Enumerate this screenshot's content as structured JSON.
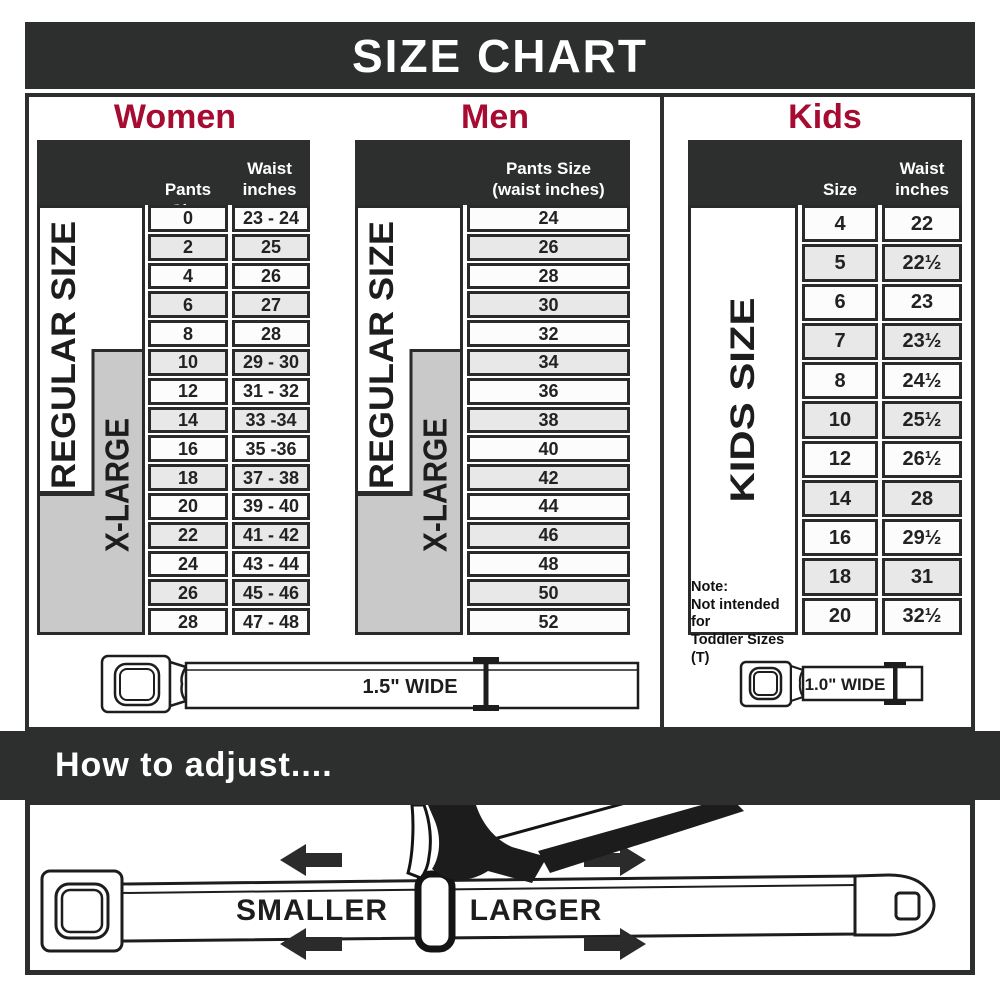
{
  "title": "SIZE CHART",
  "colors": {
    "dark": "#2d2e2e",
    "accent_crimson": "#a60c31",
    "xlarge_gray": "#c9c9c9",
    "row_alt": "#e8e8e8"
  },
  "women": {
    "heading": "Women",
    "col_pants": "Pants Size",
    "col_waist_line1": "Waist",
    "col_waist_line2": "inches",
    "regular_label": "REGULAR SIZE",
    "xlarge_label": "X-LARGE",
    "rows": [
      {
        "size": "0",
        "waist": "23 - 24"
      },
      {
        "size": "2",
        "waist": "25"
      },
      {
        "size": "4",
        "waist": "26"
      },
      {
        "size": "6",
        "waist": "27"
      },
      {
        "size": "8",
        "waist": "28"
      },
      {
        "size": "10",
        "waist": "29 - 30"
      },
      {
        "size": "12",
        "waist": "31 - 32"
      },
      {
        "size": "14",
        "waist": "33 -34"
      },
      {
        "size": "16",
        "waist": "35 -36"
      },
      {
        "size": "18",
        "waist": "37 - 38"
      },
      {
        "size": "20",
        "waist": "39 - 40"
      },
      {
        "size": "22",
        "waist": "41 - 42"
      },
      {
        "size": "24",
        "waist": "43 - 44"
      },
      {
        "size": "26",
        "waist": "45 - 46"
      },
      {
        "size": "28",
        "waist": "47 - 48"
      }
    ]
  },
  "men": {
    "heading": "Men",
    "col_line1": "Pants Size",
    "col_line2": "(waist inches)",
    "regular_label": "REGULAR SIZE",
    "xlarge_label": "X-LARGE",
    "rows": [
      "24",
      "26",
      "28",
      "30",
      "32",
      "34",
      "36",
      "38",
      "40",
      "42",
      "44",
      "46",
      "48",
      "50",
      "52"
    ]
  },
  "kids": {
    "heading": "Kids",
    "col_size": "Size",
    "col_waist_line1": "Waist",
    "col_waist_line2": "inches",
    "side_label": "KIDS SIZE",
    "note_lines": [
      "Note:",
      "Not intended for",
      "Toddler Sizes (T)"
    ],
    "rows": [
      {
        "size": "4",
        "waist": "22"
      },
      {
        "size": "5",
        "waist": "22½"
      },
      {
        "size": "6",
        "waist": "23"
      },
      {
        "size": "7",
        "waist": "23½"
      },
      {
        "size": "8",
        "waist": "24½"
      },
      {
        "size": "10",
        "waist": "25½"
      },
      {
        "size": "12",
        "waist": "26½"
      },
      {
        "size": "14",
        "waist": "28"
      },
      {
        "size": "16",
        "waist": "29½"
      },
      {
        "size": "18",
        "waist": "31"
      },
      {
        "size": "20",
        "waist": "32½"
      }
    ]
  },
  "belts": {
    "adult_width_label": "1.5\" WIDE",
    "kids_width_label": "1.0\" WIDE"
  },
  "adjust": {
    "heading": "How to adjust....",
    "smaller": "SMALLER",
    "larger": "LARGER"
  }
}
